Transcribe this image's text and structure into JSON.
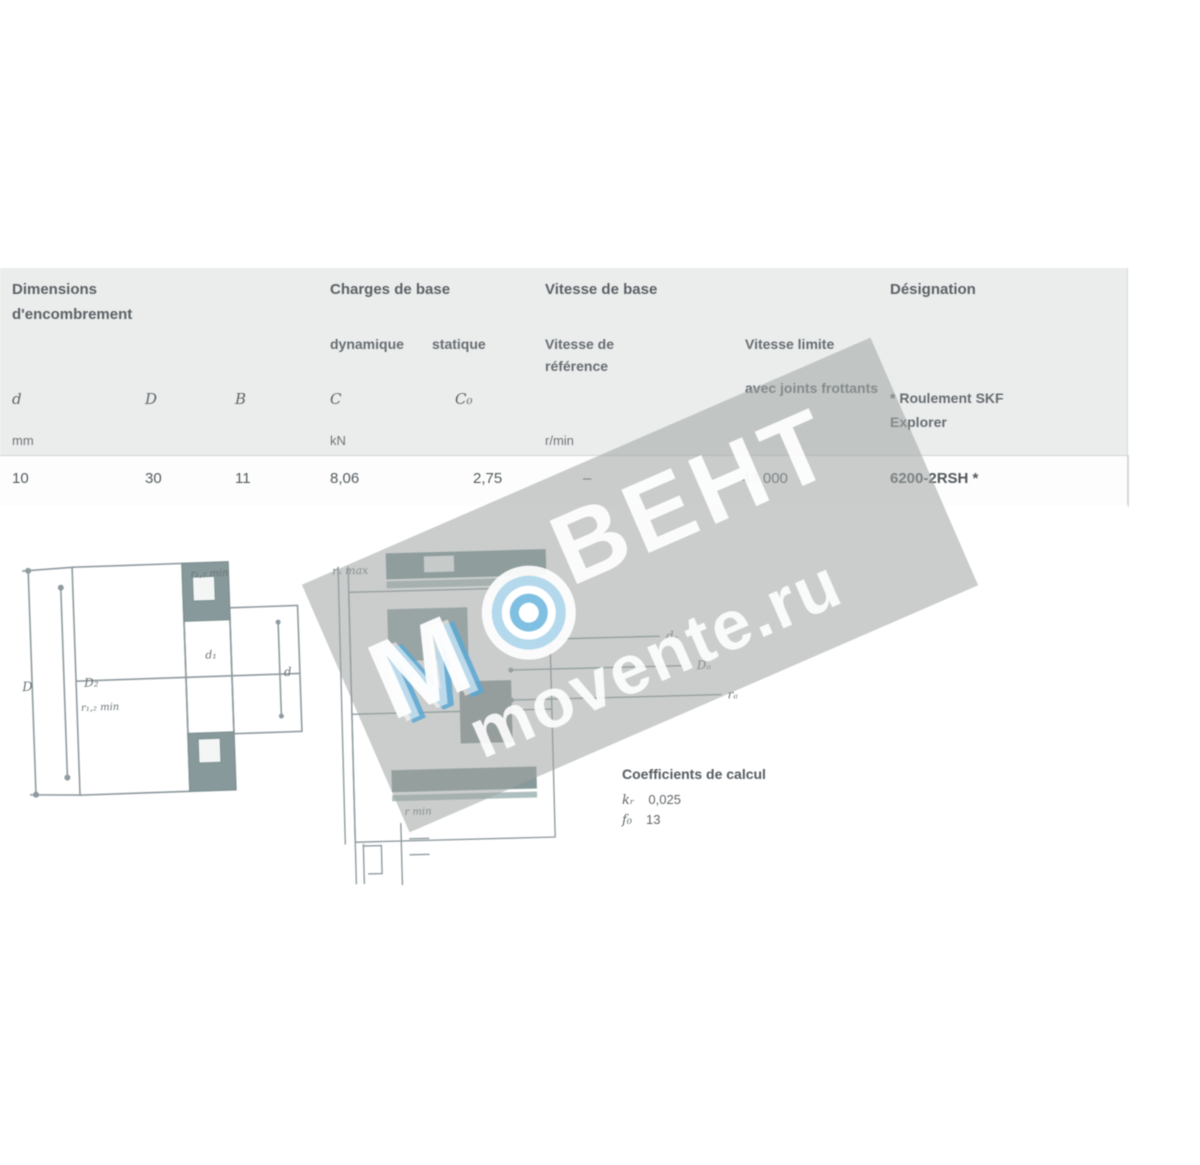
{
  "table": {
    "col_dimensions": {
      "title": "Dimensions",
      "subtitle": "d'encombrement"
    },
    "col_loads": {
      "title": "Charges de base",
      "sub_dynamic": "dynamique",
      "sub_static": "statique"
    },
    "col_speeds": {
      "title": "Vitesse de base",
      "ref_line1": "Vitesse de",
      "ref_line2": "référence",
      "lim_line1": "Vitesse limite",
      "lim_line2": "avec joints frottants"
    },
    "col_designation": {
      "title": "Désignation",
      "note1": "* Roulement SKF",
      "note2": "Explorer"
    },
    "symbols": {
      "d": "d",
      "D": "D",
      "B": "B",
      "C": "C",
      "C0": "C₀"
    },
    "units": {
      "dimensions": "mm",
      "loads": "kN",
      "speeds": "r/min"
    },
    "row": {
      "d": "10",
      "D": "30",
      "B": "11",
      "C": "8,06",
      "C0": "2,75",
      "ref_speed": "–",
      "lim_speed": "43 000",
      "designation": "6200-2RSH *"
    }
  },
  "calc": {
    "title": "Coefficients de calcul",
    "k_sym": "kᵣ",
    "k_val": "0,025",
    "f_sym": "f₀",
    "f_val": "13"
  },
  "drawing_left": {
    "labels": {
      "D": "D",
      "D2": "D₂",
      "r12": "r₁,₂ min",
      "d1": "d₁",
      "d": "d"
    }
  },
  "drawing_mid": {
    "labels": {
      "ra_max": "rₐ max",
      "da": "dₐ",
      "Da": "Dₐ",
      "ra": "rₐ",
      "r_min": "r min"
    }
  },
  "watermark": {
    "brand": "ВЕНТ",
    "site": "movente.ru",
    "mark": "М"
  },
  "colors": {
    "band": "rgba(158,164,162,0.55)",
    "blue": "#5ba8d4",
    "light_blue": "#b4d9ec",
    "header_bg": "#ebedec",
    "teal": "#87999a"
  }
}
